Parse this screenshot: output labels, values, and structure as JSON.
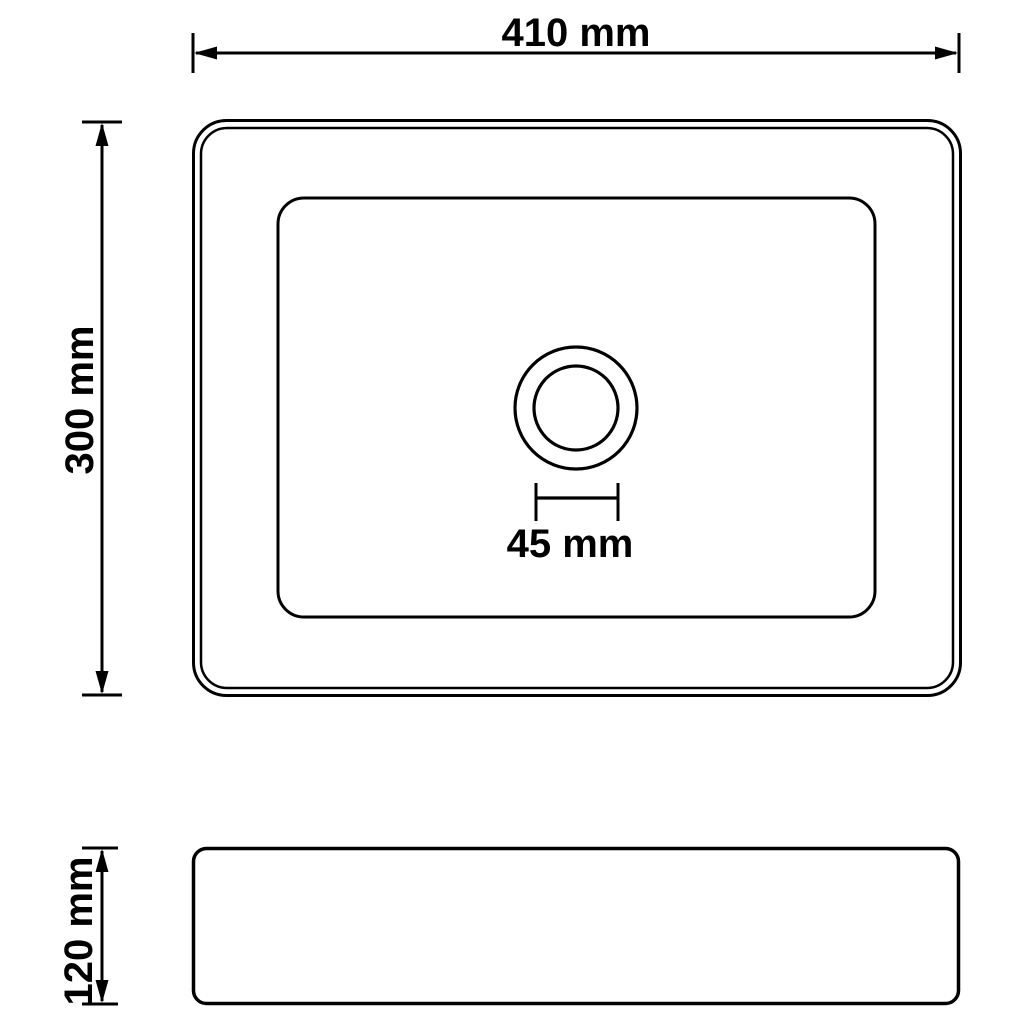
{
  "figure": {
    "kind": "technical-dimension-drawing",
    "subject": "rectangular wash basin with drain, top view and side view",
    "background_color": "#ffffff",
    "line_color": "#000000"
  },
  "dimensions": {
    "width": {
      "label": "410 mm",
      "value_mm": 410,
      "applies_to": "top view overall width"
    },
    "height": {
      "label": "300 mm",
      "value_mm": 300,
      "applies_to": "top view overall depth"
    },
    "drain": {
      "label": "45 mm",
      "value_mm": 45,
      "applies_to": "drain hole diameter"
    },
    "depth": {
      "label": "120 mm",
      "value_mm": 120,
      "applies_to": "side view overall height"
    }
  }
}
